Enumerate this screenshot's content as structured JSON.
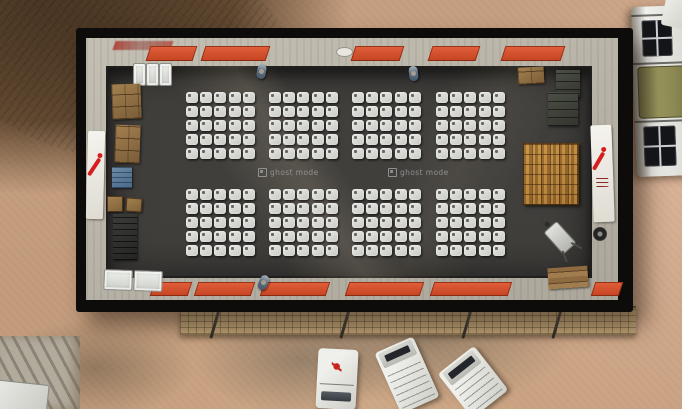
{
  "scene": {
    "view": "top-down aerial",
    "setting": "MSF field hospital ward in a desert compound",
    "watermark": {
      "label": "ghost mode",
      "icon": "ghost-mode-icon",
      "occurrences": 2
    }
  },
  "building": {
    "structure": "rectangular warehouse, open roof view",
    "floor": "dark concrete",
    "banners": [
      {
        "side": "left",
        "logo": "MSF"
      },
      {
        "side": "right",
        "logo": "MSF"
      }
    ],
    "door_mats": {
      "top_count": 5,
      "bottom_count": 6,
      "color_name": "orange"
    },
    "beds": {
      "block_rows": 2,
      "block_cols": 4,
      "rows_per_block": 5,
      "cols_per_block": 5,
      "total": 200
    }
  },
  "props": {
    "left_wall": [
      "cardboard-box-stack",
      "cardboard-box-stack",
      "blue-crate",
      "wooden-box",
      "dark-shelf-stack",
      "white-cots-pair"
    ],
    "top_wall": [
      "white-cot",
      "white-cot",
      "white-cot",
      "person",
      "person",
      "red-wall-sign"
    ],
    "right_side": [
      "cardboard-box",
      "dark-crate-stack",
      "wooden-pallet",
      "wheelbarrow",
      "wood-planks",
      "metal-drum"
    ],
    "bottom": [
      "person"
    ]
  },
  "exterior": {
    "barrier_wall": "hesco-style sand wall",
    "tent_poles": 4,
    "vehicles": {
      "bottom": 3,
      "right_edge": 2,
      "bottom_left_partial": 1
    }
  },
  "colors": {
    "msf_red": "#d51f1e",
    "mat_orange": "#d4502a",
    "floor_dark": "#413f3c",
    "wall_gray": "#b3aea3",
    "bed_white": "#e2e2de",
    "pallet_tan": "#c28d42",
    "sand": "#c49e7e",
    "rock_brown": "#5d4730",
    "hesco_tan": "#bfa277",
    "tarp_olive": "#8f8c55",
    "crate_blue": "#5a7b96"
  }
}
